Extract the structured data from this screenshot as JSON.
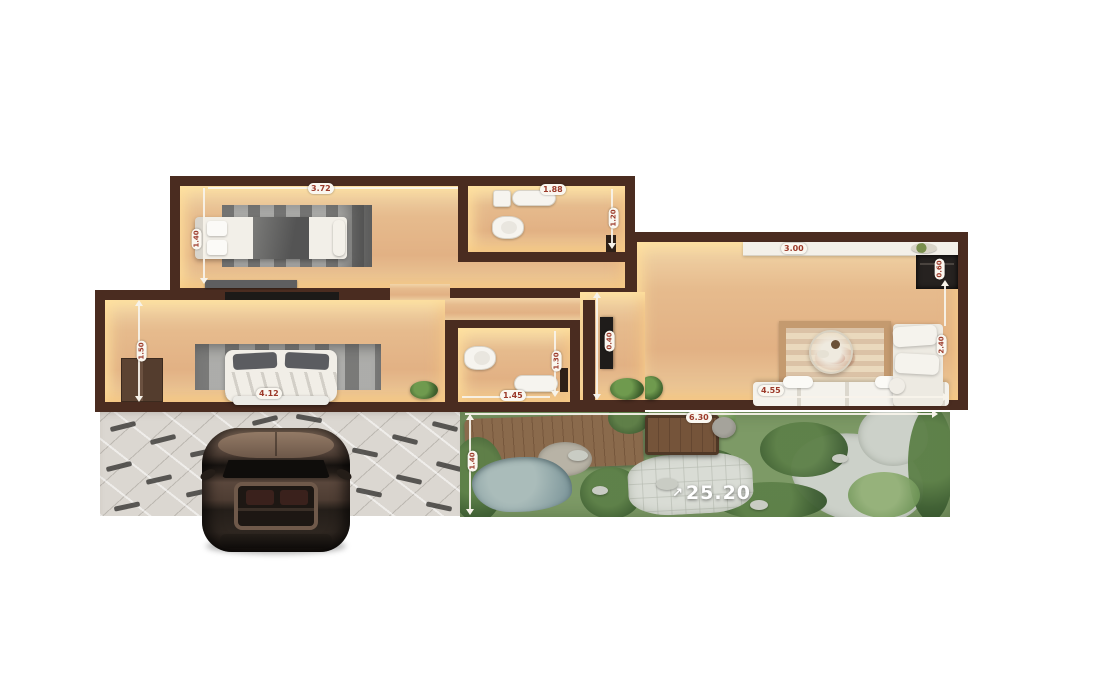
{
  "labels": {
    "bedroom1_width": "3.72",
    "bedroom1_side": "1.40",
    "bathroom1_width": "1.88",
    "bathroom1_side": "1.20",
    "living_counter": "3.00",
    "living_unit": "0.60",
    "sofa_width": "4.55",
    "sofa_side": "2.40",
    "bedroom2_width": "4.12",
    "bedroom2_side": "1.50",
    "bathroom2_width": "1.45",
    "bathroom2_side": "1.30",
    "hall_tv": "0.40",
    "garden_deck": "6.30",
    "garden_side": "1.40",
    "garden_area": "25.20"
  },
  "icons": {
    "garden_area_arrow": "↗"
  },
  "colors": {
    "wall": "#4a2c20",
    "floor_glow": "#ffe3a0",
    "label_text": "#9c3a2a",
    "dim_line": "#f7f3ea",
    "garden_green": "#6a8f55",
    "pond": "#93a9a9",
    "pavement": "#dbd7d1",
    "car_body": "#54423a"
  }
}
